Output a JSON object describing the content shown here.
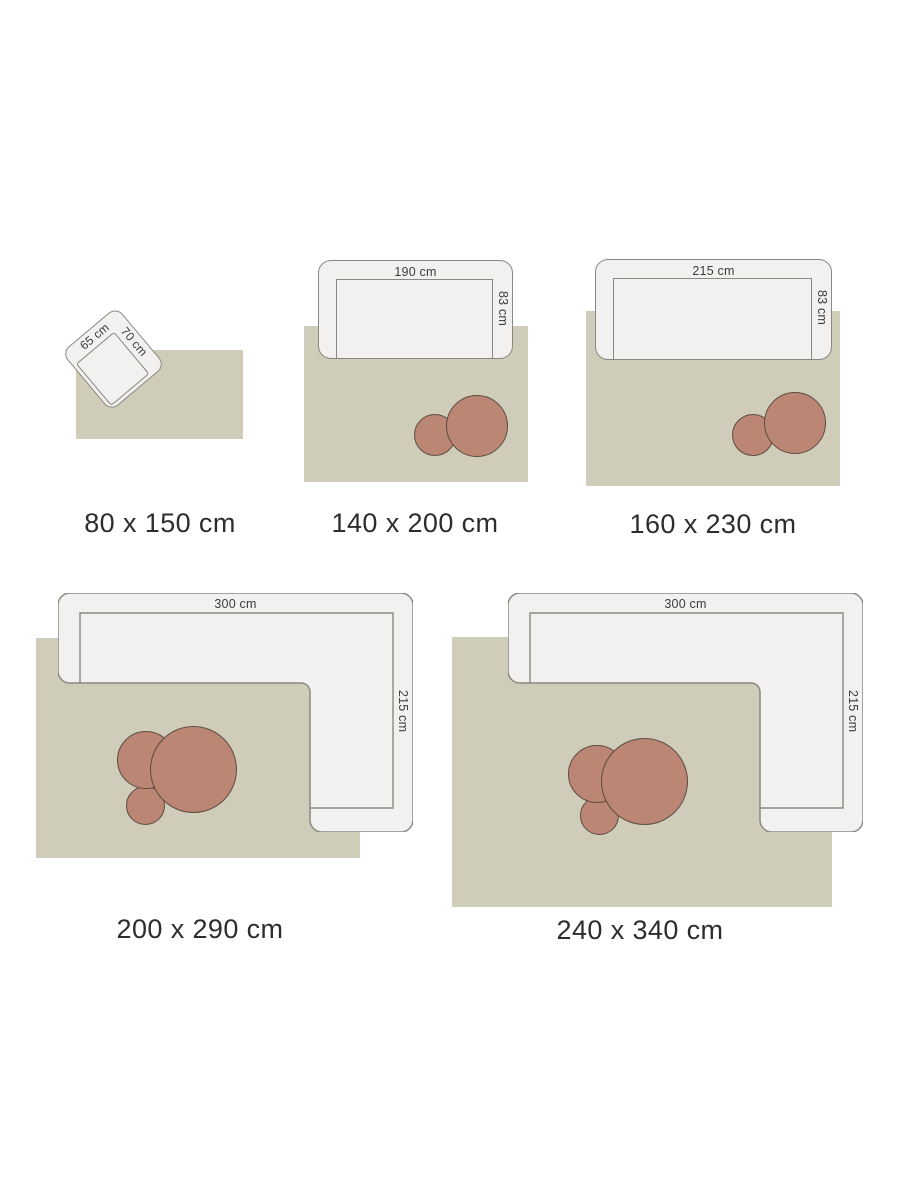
{
  "page": {
    "description": "Rug size guide showing five rug sizes with furniture drawn to scale",
    "background": "#ffffff"
  },
  "colors": {
    "rug": "#cfccba",
    "furniture_fill": "#f2f1ef",
    "furniture_outline": "#8a8880",
    "side_table_fill": "#bc8674",
    "side_table_outline": "#5c4b41",
    "size_label_text": "#2d2d2d",
    "dimension_text": "#3c3c3c"
  },
  "diagrams": [
    {
      "size_label": "80 x 150 cm",
      "furniture": "armchair",
      "furniture_dims": {
        "side": "65 cm",
        "top": "70 cm"
      }
    },
    {
      "size_label": "140 x 200 cm",
      "furniture": "sofa",
      "furniture_dims": {
        "top": "190 cm",
        "side": "83 cm"
      }
    },
    {
      "size_label": "160 x 230 cm",
      "furniture": "sofa",
      "furniture_dims": {
        "top": "215 cm",
        "side": "83 cm"
      }
    },
    {
      "size_label": "200 x 290 cm",
      "furniture": "corner sofa",
      "furniture_dims": {
        "top": "300 cm",
        "side": "215 cm"
      }
    },
    {
      "size_label": "240 x 340 cm",
      "furniture": "corner sofa",
      "furniture_dims": {
        "top": "300 cm",
        "side": "215 cm"
      }
    }
  ]
}
